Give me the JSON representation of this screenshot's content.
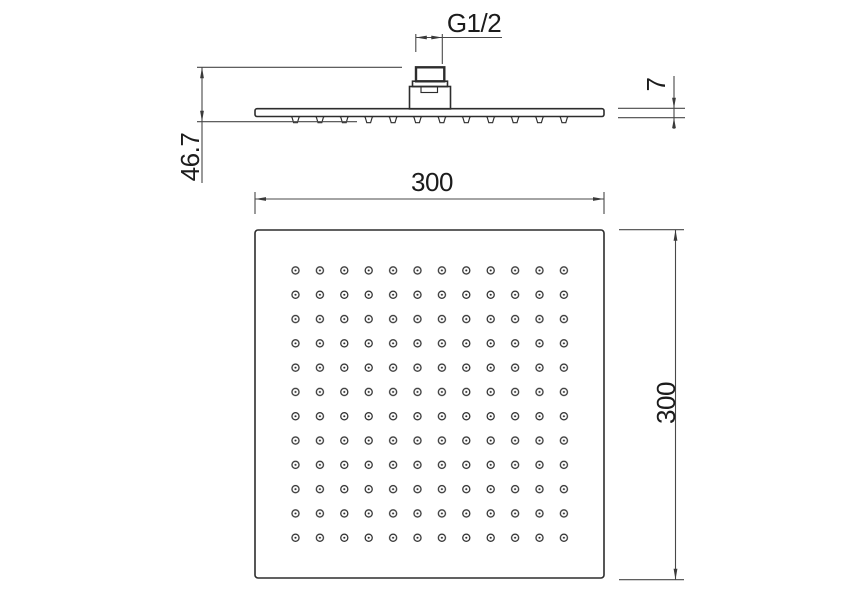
{
  "drawing": {
    "side_view": {
      "thread_label": "G1/2",
      "height_label": "46.7",
      "thickness_label": "7"
    },
    "face_view": {
      "width_label": "300",
      "depth_label": "300",
      "nozzle_rows": 12,
      "nozzle_cols": 12
    },
    "colors": {
      "object_line": "#2d2d2d",
      "dimension_line": "#484848",
      "text": "#1c1c1c",
      "background": "#ffffff"
    }
  }
}
